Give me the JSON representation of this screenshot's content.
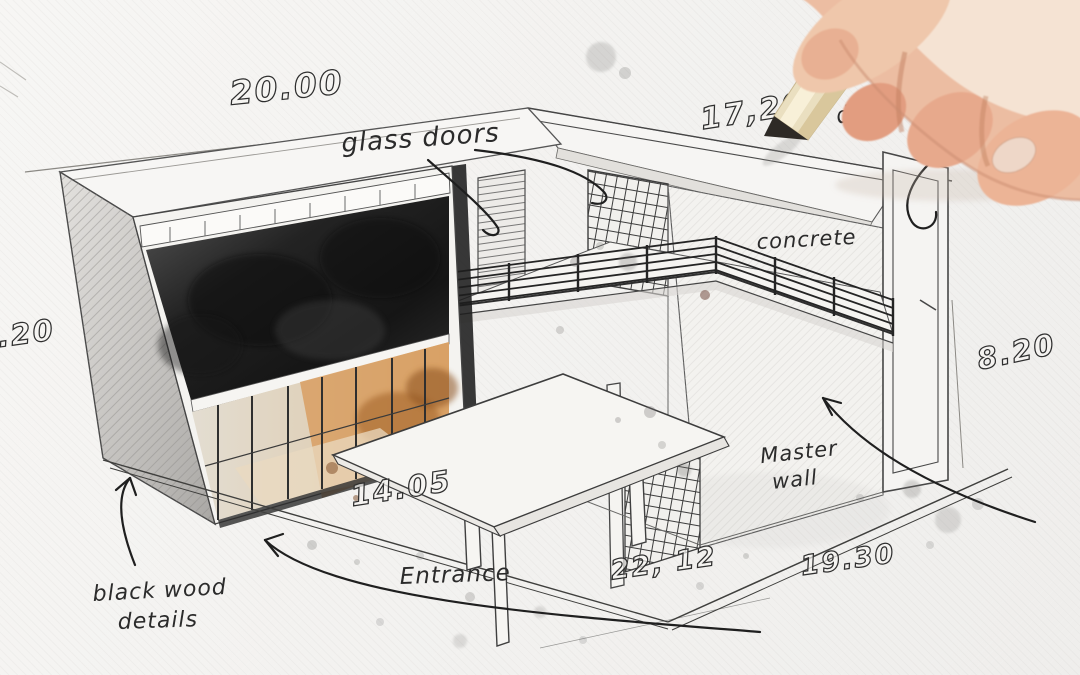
{
  "sketch": {
    "dimensions": {
      "top": "20.00",
      "top_right": "17,20",
      "right": "8.20",
      "left": "8.20",
      "floor": "14.05",
      "bottom_center": "22, 12",
      "bottom_right": "19.30"
    },
    "labels": {
      "glass_doors": "glass doors",
      "concrete": "concrete",
      "master_wall_line1": "Master",
      "master_wall_line2": "wall",
      "entrance": "Entrance",
      "black_wood_line1": "black wood",
      "black_wood_line2": "details",
      "partial_letter": "a",
      "partial_word": "de"
    },
    "colors": {
      "paper": "#f3f2ef",
      "ink": "#2b2b2b",
      "charcoal_wall": "#1b1b1b",
      "side_wall_gray": "#b7b5b2",
      "interior_wood": "#d29a5e",
      "interior_wood_deep": "#985c26",
      "glass": "#ddd8cc",
      "pencil_wood": "#eadfc0",
      "pencil_tip": "#2e2a26",
      "skin": "#ecbda2",
      "skin_light": "#f5e3d3",
      "skin_shadow": "#c2805f",
      "splatter_gray": "#6f6e6c",
      "splatter_brown": "#7a451f"
    }
  }
}
